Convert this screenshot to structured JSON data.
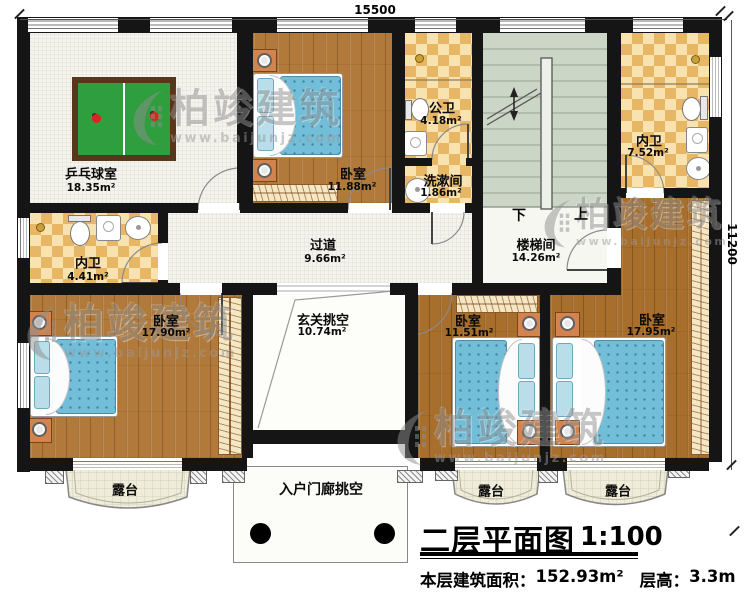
{
  "dimensions": {
    "width_label": "15500",
    "height_label": "11200"
  },
  "watermark": {
    "brand": "柏竣建筑",
    "url": "www.baijunjz.com"
  },
  "rooms": {
    "pingpong": {
      "name": "乒乓球室",
      "area": "18.35m²"
    },
    "bedroom_top": {
      "name": "卧室",
      "area": "11.88m²"
    },
    "public_bath": {
      "name": "公卫",
      "area": "4.18m²"
    },
    "washroom": {
      "name": "洗漱间",
      "area": "1.86m²"
    },
    "bath_right": {
      "name": "内卫",
      "area": "7.52m²"
    },
    "stairwell": {
      "name": "楼梯间",
      "area": "14.26m²",
      "down": "下",
      "up": "上"
    },
    "corridor": {
      "name": "过道",
      "area": "9.66m²"
    },
    "bath_left": {
      "name": "内卫",
      "area": "4.41m²"
    },
    "bedroom_left": {
      "name": "卧室",
      "area": "17.90m²"
    },
    "foyer_void": {
      "name": "玄关挑空",
      "area": "10.74m²"
    },
    "bedroom_mid": {
      "name": "卧室",
      "area": "11.51m²"
    },
    "bedroom_right": {
      "name": "卧室",
      "area": "17.95m²"
    },
    "terrace_left": {
      "name": "露台"
    },
    "terrace_mid": {
      "name": "露台"
    },
    "terrace_right": {
      "name": "露台"
    },
    "porch_void": {
      "name": "入户门廊挑空"
    }
  },
  "title_block": {
    "title": "二层平面图",
    "scale": "1:100",
    "area_label": "本层建筑面积：",
    "area_value": "152.93m²",
    "height_label": "层高：",
    "height_value": "3.3m"
  },
  "colors": {
    "wall": "#151515",
    "wood": "#b1793a",
    "wood_dark": "#a86e2c",
    "tile_checker": "#e8b765",
    "stair_green": "#ccd6c7",
    "mattress_blue": "#72bed8",
    "table_green": "#2f9e3f",
    "terrace": "#efecd9",
    "nightstand": "#d2834e",
    "watermark_gray": "#8f8f8f"
  }
}
